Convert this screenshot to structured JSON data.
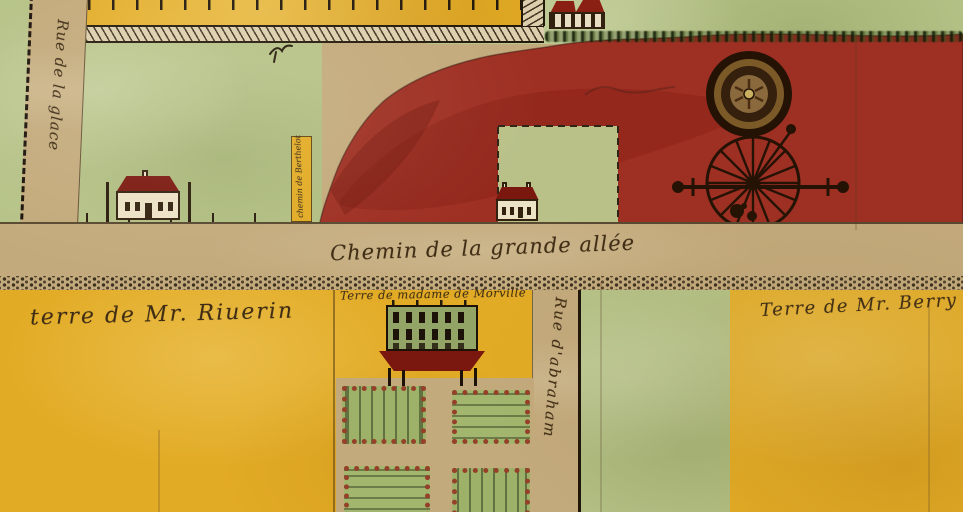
{
  "map": {
    "title": "Hand-drawn watercolor cadastral plan",
    "labels": {
      "main_road": "Chemin de la grande allée",
      "riverin": "terre de Mr. Riuerin",
      "morville": "Terre de madame de Morville",
      "berry": "Terre de Mr. Berry",
      "rue_glace": "Rue de la glace",
      "rue_abraham": "Rue d'abraham",
      "chemin_berthelot": "chemin de Berthelot"
    },
    "icons": {
      "windmill": "windmill-wheel-icon",
      "tower": "round-tower-icon",
      "bird": "bird-mark-icon",
      "houses": "house-icon",
      "manor": "manor-building-icon",
      "garden": "formal-garden"
    },
    "colors": {
      "parchment": "#c7ae84",
      "road_tan": "#c3aa7c",
      "field_green": "#b5c287",
      "parcel_yellow": "#e2ab25",
      "cleared_red": "#9e2f23",
      "roof_red": "#7a180f",
      "ink": "#3f2d15",
      "bed_border": "#96402a"
    }
  }
}
